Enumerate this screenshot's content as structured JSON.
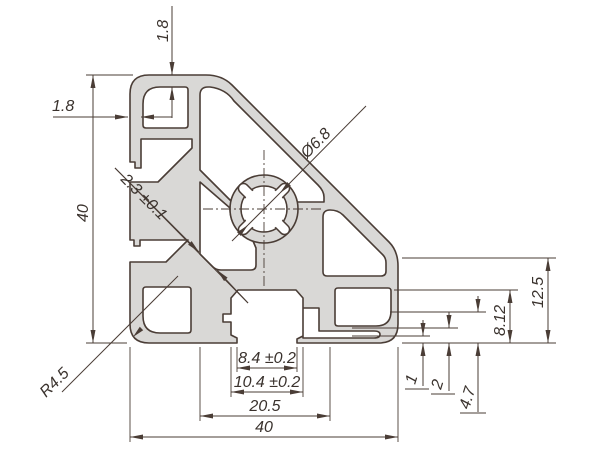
{
  "drawing": {
    "type": "technical-cross-section",
    "subject": "45-degree aluminium extrusion profile",
    "colors": {
      "metal": "#d9d8d6",
      "line": "#4a3d36",
      "ink": "#3a322d",
      "background": "#ffffff"
    },
    "dimensions": {
      "top_wall": "1.8",
      "left_wall": "1.8",
      "height": "40",
      "diag_web": "2.3 ±0.1",
      "center_hole": "Ø6.8",
      "corner_radius": "R4.5",
      "slot_inner_width": "8.4 ±0.2",
      "slot_outer_width": "10.4 ±0.2",
      "slot_span": "20.5",
      "width": "40",
      "right_edge_height": "12.5",
      "right_mid_height": "8.12",
      "lip_small": "1",
      "lip_mid": "2",
      "lip_large": "4.7"
    }
  }
}
